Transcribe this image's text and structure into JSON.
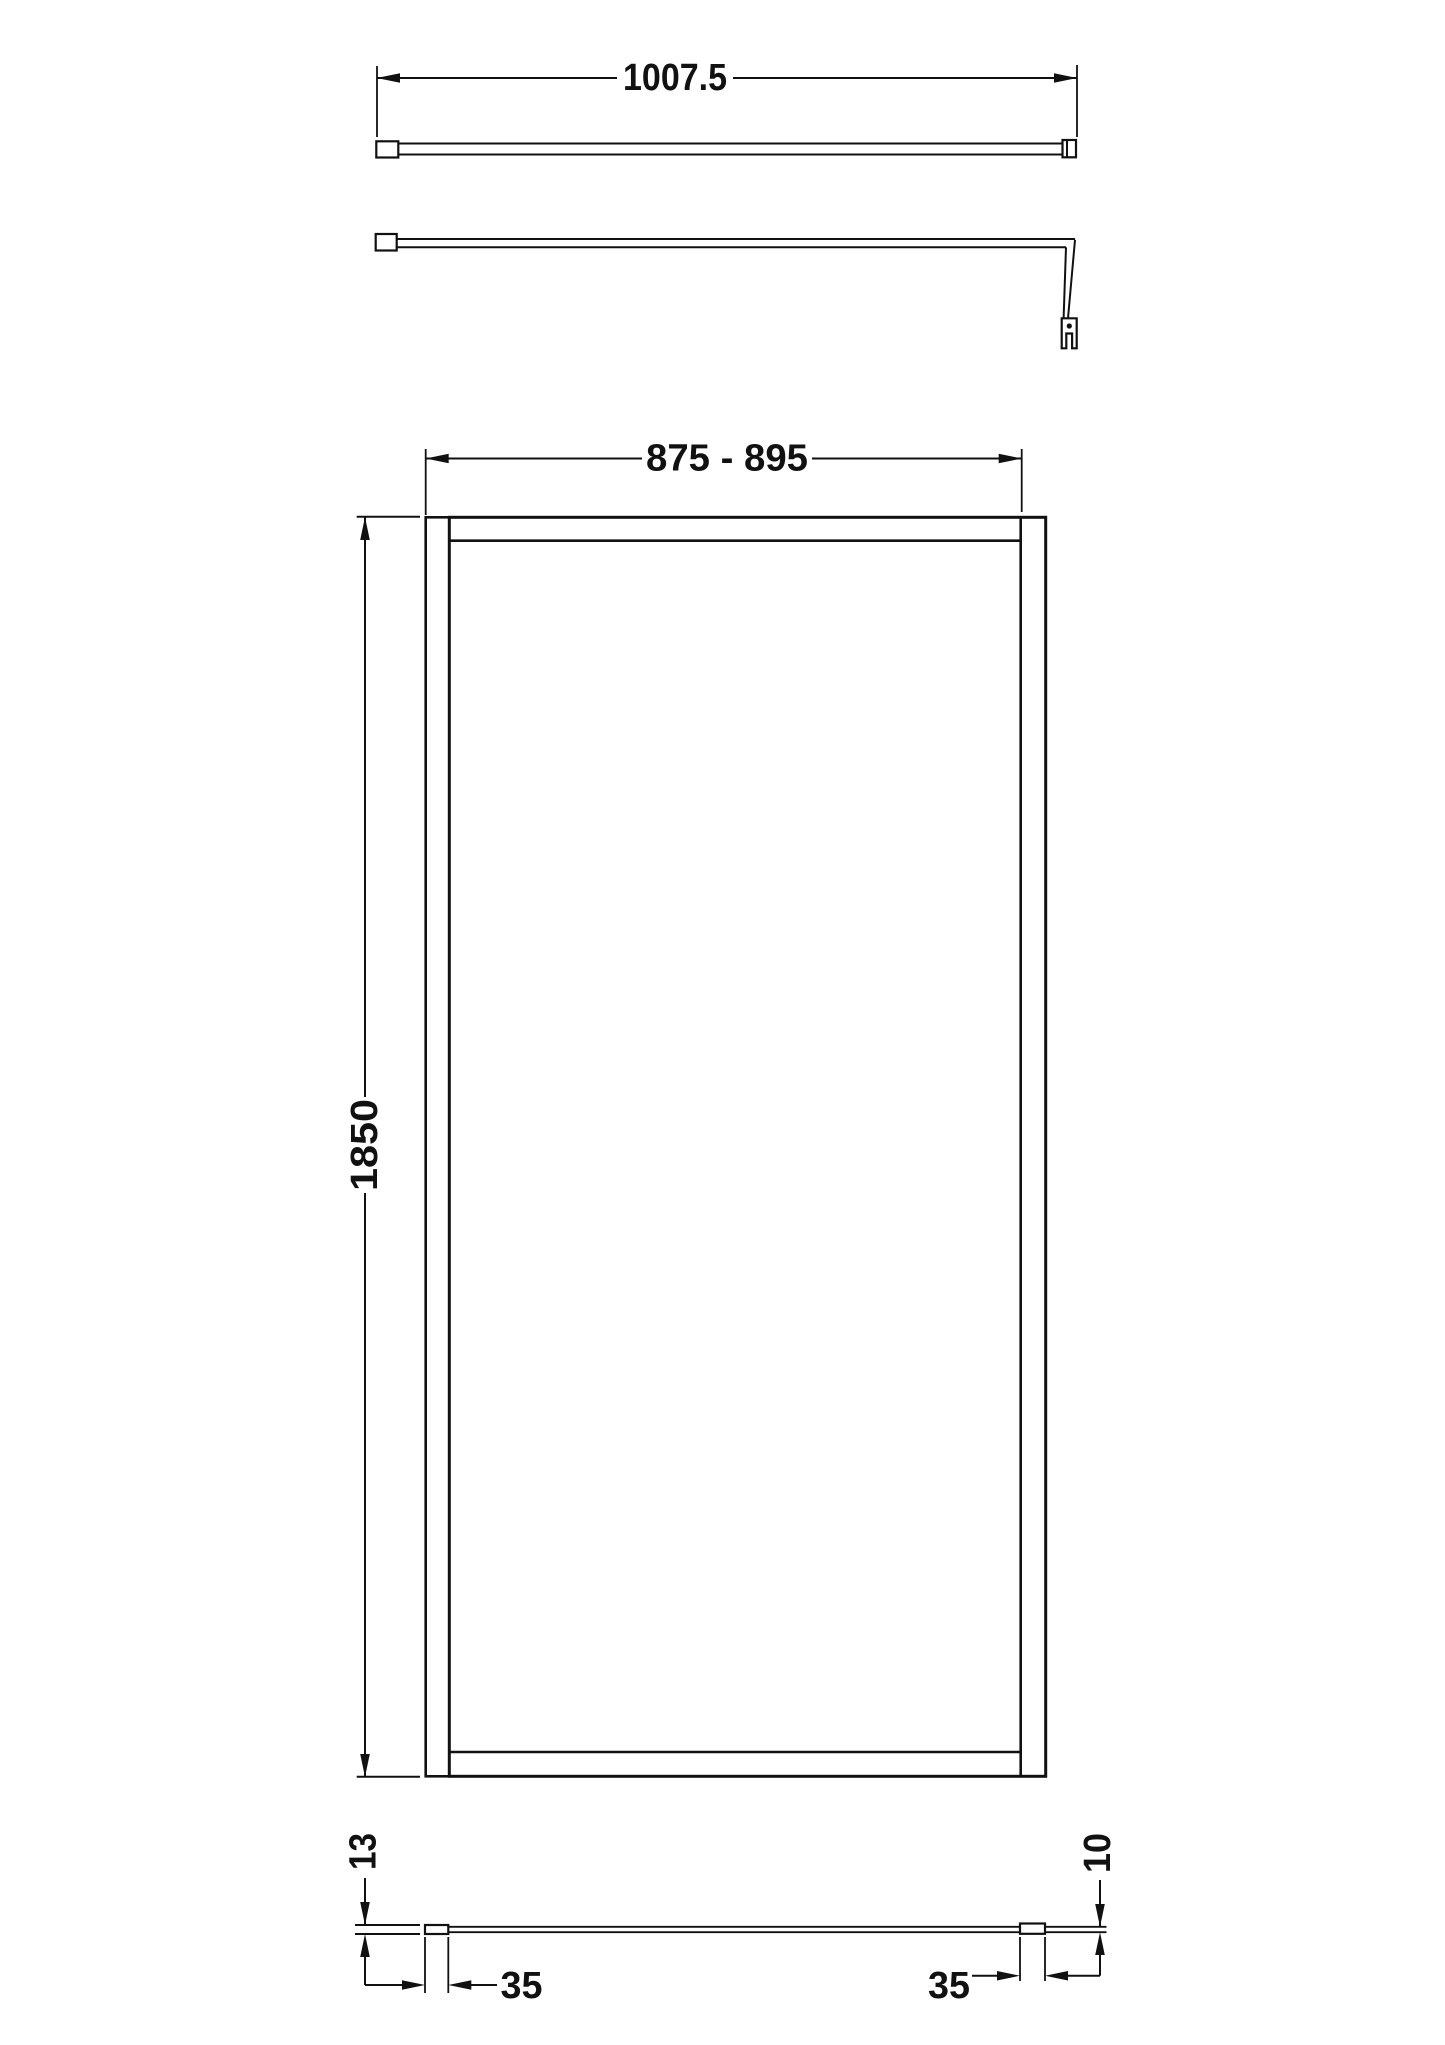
{
  "drawing": {
    "background": "#ffffff",
    "line_color": "#111111",
    "dimensions": {
      "support_arm_length": "1007.5",
      "screen_width_range": "875 - 895",
      "screen_height": "1850",
      "wall_profile_depth": "13",
      "wall_profile_width": "35",
      "glass_thickness": "10",
      "end_profile_width": "35"
    }
  }
}
